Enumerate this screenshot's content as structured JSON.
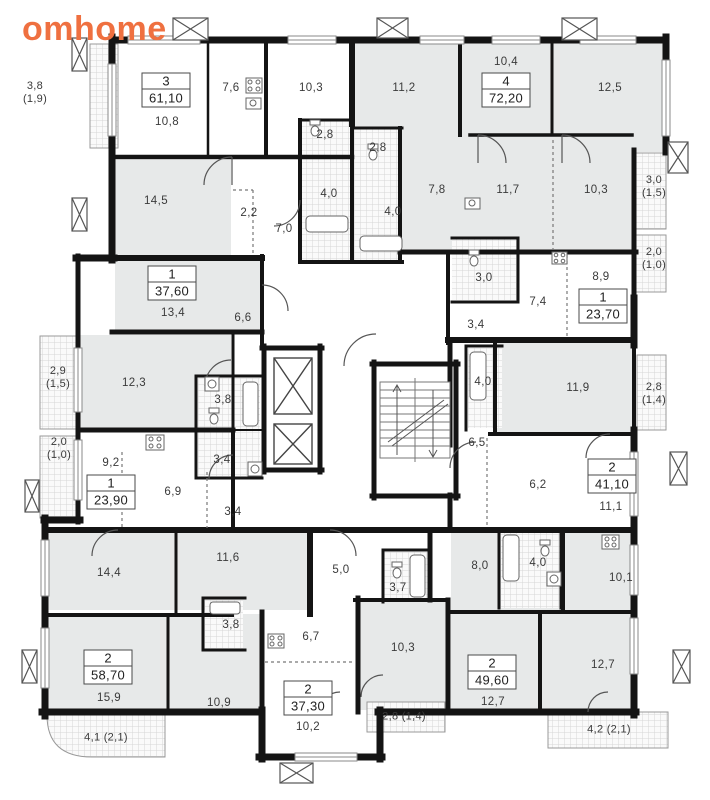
{
  "brand": {
    "name": "omhome",
    "color": "#ef7040"
  },
  "apartments": [
    {
      "rooms": "3",
      "area": "61,10"
    },
    {
      "rooms": "4",
      "area": "72,20"
    },
    {
      "rooms": "1",
      "area": "37,60"
    },
    {
      "rooms": "1",
      "area": "23,70"
    },
    {
      "rooms": "1",
      "area": "23,90"
    },
    {
      "rooms": "2",
      "area": "41,10"
    },
    {
      "rooms": "2",
      "area": "58,70"
    },
    {
      "rooms": "2",
      "area": "37,30"
    },
    {
      "rooms": "2",
      "area": "49,60"
    }
  ],
  "room_areas": [
    "10,8",
    "7,6",
    "10,3",
    "11,2",
    "10,4",
    "12,5",
    "14,5",
    "2,2",
    "7,0",
    "2,8",
    "2,8",
    "4,0",
    "4,0",
    "7,8",
    "11,7",
    "10,3",
    "13,4",
    "6,6",
    "3,0",
    "7,4",
    "8,9",
    "3,4",
    "12,3",
    "3,8",
    "9,2",
    "3,4",
    "6,9",
    "3,4",
    "4,0",
    "11,9",
    "6,5",
    "6,2",
    "11,1",
    "14,4",
    "11,6",
    "3,8",
    "15,9",
    "10,9",
    "5,0",
    "3,7",
    "6,7",
    "10,3",
    "10,2",
    "8,0",
    "4,0",
    "10,1",
    "12,7",
    "12,7"
  ],
  "balcony_areas": [
    {
      "line1": "3,8",
      "line2": "(1,9)"
    },
    {
      "line1": "3,0",
      "line2": "(1,5)"
    },
    {
      "line1": "2,0",
      "line2": "(1,0)"
    },
    {
      "line1": "2,9",
      "line2": "(1,5)"
    },
    {
      "line1": "2,0",
      "line2": "(1,0)"
    },
    {
      "line1": "2,8",
      "line2": "(1,4)"
    },
    {
      "line1": "4,1 (2,1)",
      "line2": ""
    },
    {
      "line1": "2,8 (1,4)",
      "line2": ""
    },
    {
      "line1": "4,2 (2,1)",
      "line2": ""
    }
  ]
}
